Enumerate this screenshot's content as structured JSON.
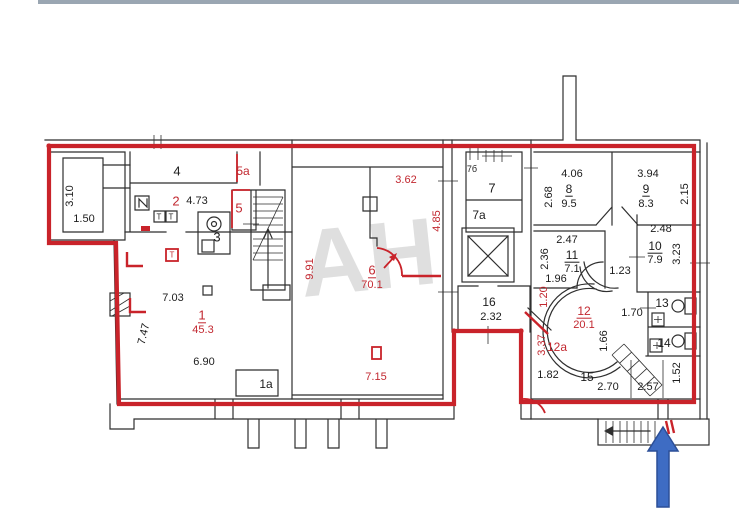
{
  "page": {
    "background": "#ffffff",
    "top_strip_color": "#8f9caa"
  },
  "plan": {
    "watermark_text": "АН",
    "boundary_color": "#c9232a",
    "wall_color": "#2f2f2f",
    "black_label_color": "#1c1c1c",
    "red_label_color": "#c22830",
    "watermark_color": "#c6c6c6",
    "entrance_arrow_color": "#3e6cc3",
    "entrance_arrow_border": "#2c4f97"
  },
  "icons": {
    "entrance_arrow": "blue-up-arrow",
    "elevator": "crossed-box-elevator",
    "interior_stairs": "stair-treads-with-up-arrow",
    "exterior_stairs": "stair-treads-with-left-arrow",
    "bathroom": "toilet-and-sink-fixtures",
    "electric_panel": "zigzag-box"
  },
  "labels": [
    {
      "t": "3.10",
      "x": 70,
      "y": 196,
      "r": -90
    },
    {
      "t": "1.50",
      "x": 84,
      "y": 219
    },
    {
      "t": "4",
      "x": 177,
      "y": 171,
      "s": 13
    },
    {
      "t": "2",
      "x": 176,
      "y": 201,
      "c": "r",
      "s": 13
    },
    {
      "t": "4.73",
      "x": 197,
      "y": 201
    },
    {
      "t": "5a",
      "x": 243,
      "y": 171,
      "c": "r",
      "s": 12
    },
    {
      "t": "5",
      "x": 239,
      "y": 208,
      "c": "r",
      "s": 13
    },
    {
      "t": "3",
      "x": 217,
      "y": 237,
      "s": 13
    },
    {
      "t": "Т",
      "x": 159,
      "y": 217,
      "s": 8
    },
    {
      "t": "Т",
      "x": 171,
      "y": 217,
      "s": 8
    },
    {
      "t": "Т",
      "x": 172,
      "y": 255,
      "s": 8,
      "c": "r"
    },
    {
      "t": "7.03",
      "x": 173,
      "y": 298
    },
    {
      "t": "1",
      "x": 202,
      "y": 315,
      "c": "r",
      "s": 13,
      "u": true
    },
    {
      "t": "45.3",
      "x": 203,
      "y": 330,
      "c": "r"
    },
    {
      "t": "6.90",
      "x": 204,
      "y": 362
    },
    {
      "t": "7.47",
      "x": 144,
      "y": 334,
      "r": -77
    },
    {
      "t": "1a",
      "x": 266,
      "y": 384,
      "s": 12
    },
    {
      "t": "9.91",
      "x": 310,
      "y": 269,
      "r": -90,
      "c": "r"
    },
    {
      "t": "3.62",
      "x": 406,
      "y": 180,
      "c": "r"
    },
    {
      "t": "4.85",
      "x": 437,
      "y": 221,
      "r": -90,
      "c": "r"
    },
    {
      "t": "6",
      "x": 372,
      "y": 270,
      "c": "r",
      "s": 13,
      "u": true
    },
    {
      "t": "70.1",
      "x": 372,
      "y": 285,
      "c": "r"
    },
    {
      "t": "7.15",
      "x": 376,
      "y": 377,
      "c": "r"
    },
    {
      "t": "7б",
      "x": 472,
      "y": 169,
      "s": 9
    },
    {
      "t": "7",
      "x": 492,
      "y": 188,
      "s": 13
    },
    {
      "t": "7a",
      "x": 479,
      "y": 215,
      "s": 12
    },
    {
      "t": "16",
      "x": 489,
      "y": 302,
      "s": 12
    },
    {
      "t": "2.32",
      "x": 491,
      "y": 317
    },
    {
      "t": "4.06",
      "x": 572,
      "y": 174
    },
    {
      "t": "2.68",
      "x": 549,
      "y": 197,
      "r": -90
    },
    {
      "t": "8",
      "x": 569,
      "y": 189,
      "s": 12,
      "u": true
    },
    {
      "t": "9.5",
      "x": 569,
      "y": 204
    },
    {
      "t": "3.94",
      "x": 648,
      "y": 174
    },
    {
      "t": "9",
      "x": 646,
      "y": 189,
      "s": 12,
      "u": true
    },
    {
      "t": "8.3",
      "x": 646,
      "y": 204
    },
    {
      "t": "2.15",
      "x": 685,
      "y": 194,
      "r": -90
    },
    {
      "t": "2.47",
      "x": 567,
      "y": 240
    },
    {
      "t": "2.36",
      "x": 545,
      "y": 259,
      "r": -90
    },
    {
      "t": "11",
      "x": 572,
      "y": 255,
      "s": 12,
      "u": true
    },
    {
      "t": "7.1",
      "x": 572,
      "y": 269
    },
    {
      "t": "1.96",
      "x": 556,
      "y": 279
    },
    {
      "t": "1.23",
      "x": 620,
      "y": 271
    },
    {
      "t": "2.48",
      "x": 661,
      "y": 229
    },
    {
      "t": "10",
      "x": 655,
      "y": 246,
      "s": 12,
      "u": true
    },
    {
      "t": "7.9",
      "x": 655,
      "y": 260
    },
    {
      "t": "3.23",
      "x": 677,
      "y": 254,
      "r": -90
    },
    {
      "t": "1.20",
      "x": 544,
      "y": 297,
      "r": -90,
      "c": "r"
    },
    {
      "t": "12",
      "x": 584,
      "y": 311,
      "c": "r",
      "s": 12,
      "u": true
    },
    {
      "t": "20.1",
      "x": 584,
      "y": 325,
      "c": "r"
    },
    {
      "t": "1.70",
      "x": 632,
      "y": 313
    },
    {
      "t": "1.66",
      "x": 604,
      "y": 341,
      "r": -90
    },
    {
      "t": "13",
      "x": 662,
      "y": 303,
      "s": 12
    },
    {
      "t": "14",
      "x": 664,
      "y": 343,
      "s": 12
    },
    {
      "t": "3.37",
      "x": 542,
      "y": 345,
      "r": -90,
      "c": "r"
    },
    {
      "t": "12a",
      "x": 557,
      "y": 347,
      "c": "r",
      "s": 12
    },
    {
      "t": "1.82",
      "x": 548,
      "y": 375
    },
    {
      "t": "15",
      "x": 587,
      "y": 377,
      "s": 12
    },
    {
      "t": "2.70",
      "x": 608,
      "y": 387
    },
    {
      "t": "2.57",
      "x": 648,
      "y": 387
    },
    {
      "t": "1.52",
      "x": 677,
      "y": 373,
      "r": -90
    }
  ]
}
